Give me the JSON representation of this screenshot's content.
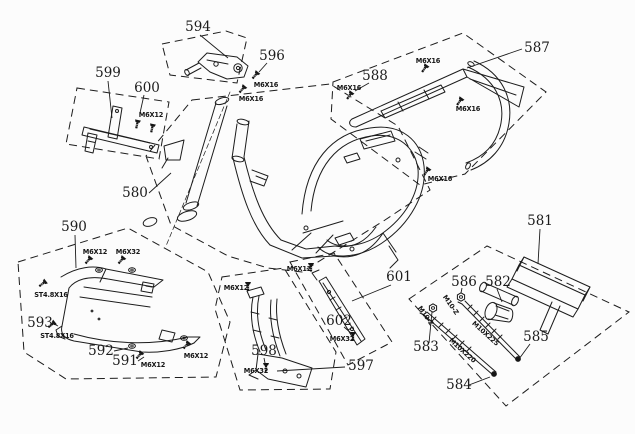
{
  "diagram": {
    "background": "#fcfcfc",
    "line_color": "#1c1c1c",
    "description_labels": {
      "part_numbers": [
        "580",
        "581",
        "582",
        "583",
        "584",
        "585",
        "586",
        "587",
        "588",
        "590",
        "591",
        "592",
        "593",
        "594",
        "596",
        "597",
        "598",
        "599",
        "600",
        "601",
        "602"
      ]
    },
    "callouts": [
      {
        "label": "594",
        "x": 198,
        "y": 31,
        "leader": [
          200,
          35,
          228,
          58
        ]
      },
      {
        "label": "596",
        "x": 272,
        "y": 60,
        "leader": [
          267,
          63,
          259,
          72
        ]
      },
      {
        "label": "599",
        "x": 108,
        "y": 77,
        "leader": [
          108,
          81,
          112,
          118
        ]
      },
      {
        "label": "600",
        "x": 147,
        "y": 92,
        "leader": [
          144,
          95,
          140,
          113
        ]
      },
      {
        "label": "587",
        "x": 537,
        "y": 52,
        "leader": [
          522,
          49,
          467,
          68
        ]
      },
      {
        "label": "588",
        "x": 375,
        "y": 80,
        "leader": [
          369,
          83,
          355,
          91
        ]
      },
      {
        "label": "580",
        "x": 135,
        "y": 197,
        "leader": [
          149,
          193,
          171,
          173
        ]
      },
      {
        "label": "590",
        "x": 74,
        "y": 231,
        "leader": [
          75,
          235,
          76,
          268
        ]
      },
      {
        "label": "593",
        "x": 40,
        "y": 327,
        "leader": [
          52,
          323,
          58,
          326
        ]
      },
      {
        "label": "592",
        "x": 101,
        "y": 355,
        "leader": [
          114,
          351,
          128,
          348
        ]
      },
      {
        "label": "591",
        "x": 125,
        "y": 365,
        "leader": [
          138,
          361,
          144,
          357
        ]
      },
      {
        "label": "598",
        "x": 264,
        "y": 355,
        "leader": [
          264,
          358,
          265,
          363
        ]
      },
      {
        "label": "597",
        "x": 361,
        "y": 370,
        "leader": [
          345,
          367,
          277,
          371
        ]
      },
      {
        "label": "601",
        "x": 399,
        "y": 281,
        "leader": [
          391,
          285,
          352,
          301
        ]
      },
      {
        "label": "602",
        "x": 339,
        "y": 325,
        "leader": [
          344,
          327,
          351,
          333
        ]
      },
      {
        "label": "581",
        "x": 540,
        "y": 225,
        "leader": [
          540,
          229,
          538,
          264
        ]
      },
      {
        "label": "586",
        "x": 464,
        "y": 286,
        "leader": [
          462,
          288,
          461,
          293
        ]
      },
      {
        "label": "582",
        "x": 498,
        "y": 286,
        "leader": [
          497,
          289,
          502,
          302
        ]
      },
      {
        "label": "583",
        "x": 426,
        "y": 351,
        "leader": [
          429,
          343,
          432,
          312
        ]
      },
      {
        "label": "585",
        "x": 536,
        "y": 341,
        "leader": [
          530,
          344,
          519,
          359
        ]
      },
      {
        "label": "584",
        "x": 459,
        "y": 389,
        "leader": [
          469,
          385,
          490,
          377
        ]
      }
    ],
    "fasteners": [
      {
        "label": "M6X16",
        "x": 266,
        "y": 87,
        "glyphs": [
          {
            "type": "bolt",
            "x": 258,
            "y": 72,
            "rot": 40
          }
        ]
      },
      {
        "label": "M6X16",
        "x": 251,
        "y": 101,
        "glyphs": [
          {
            "type": "bolt",
            "x": 245,
            "y": 86,
            "rot": 40
          }
        ]
      },
      {
        "label": "M6X16",
        "x": 428,
        "y": 63,
        "glyphs": [
          {
            "type": "bolt",
            "x": 427,
            "y": 65,
            "rot": 35
          }
        ]
      },
      {
        "label": "M6X16",
        "x": 349,
        "y": 90,
        "glyphs": [
          {
            "type": "bolt",
            "x": 352,
            "y": 92,
            "rot": 35
          }
        ]
      },
      {
        "label": "M6X16",
        "x": 468,
        "y": 111,
        "glyphs": [
          {
            "type": "bolt",
            "x": 462,
            "y": 98,
            "rot": 35
          }
        ]
      },
      {
        "label": "M6X16",
        "x": 440,
        "y": 181,
        "glyphs": [
          {
            "type": "bolt",
            "x": 429,
            "y": 168,
            "rot": 35
          }
        ]
      },
      {
        "label": "M6X12",
        "x": 151,
        "y": 117,
        "glyphs": [
          {
            "type": "bolt",
            "x": 138,
            "y": 120,
            "rot": 12
          },
          {
            "type": "bolt",
            "x": 153,
            "y": 124,
            "rot": 12
          }
        ]
      },
      {
        "label": "M6X12",
        "x": 95,
        "y": 254,
        "glyphs": [
          {
            "type": "bolt",
            "x": 91,
            "y": 257,
            "rot": 40
          },
          {
            "type": "washer",
            "x": 99,
            "y": 270,
            "rot": 0
          }
        ]
      },
      {
        "label": "M6X32",
        "x": 128,
        "y": 254,
        "glyphs": [
          {
            "type": "bolt",
            "x": 124,
            "y": 257,
            "rot": 40
          },
          {
            "type": "washer",
            "x": 132,
            "y": 270,
            "rot": 0
          }
        ]
      },
      {
        "label": "ST4.8X16",
        "x": 51,
        "y": 297,
        "glyphs": [
          {
            "type": "bolt",
            "x": 46,
            "y": 281,
            "rot": 52
          }
        ]
      },
      {
        "label": "ST4.8X16",
        "x": 57,
        "y": 338,
        "glyphs": [
          {
            "type": "bolt",
            "x": 55,
            "y": 322,
            "rot": 52
          }
        ]
      },
      {
        "label": "M6X12",
        "x": 153,
        "y": 367,
        "glyphs": [
          {
            "type": "bolt",
            "x": 142,
            "y": 352,
            "rot": 40
          },
          {
            "type": "washer",
            "x": 132,
            "y": 346,
            "rot": 0
          }
        ]
      },
      {
        "label": "M6X12",
        "x": 196,
        "y": 358,
        "glyphs": [
          {
            "type": "bolt",
            "x": 189,
            "y": 342,
            "rot": 40
          },
          {
            "type": "washer",
            "x": 184,
            "y": 338,
            "rot": 0
          }
        ]
      },
      {
        "label": "M6X12",
        "x": 236,
        "y": 290,
        "glyphs": [
          {
            "type": "bolt",
            "x": 248,
            "y": 282,
            "rot": 0
          }
        ]
      },
      {
        "label": "M6X12",
        "x": 299,
        "y": 271,
        "glyphs": [
          {
            "type": "bolt",
            "x": 311,
            "y": 263,
            "rot": 0
          }
        ]
      },
      {
        "label": "M6X32",
        "x": 342,
        "y": 341,
        "glyphs": [
          {
            "type": "bolt",
            "x": 353,
            "y": 332,
            "rot": 0
          }
        ]
      },
      {
        "label": "M6X32",
        "x": 256,
        "y": 373,
        "glyphs": [
          {
            "type": "bolt",
            "x": 266,
            "y": 363,
            "rot": 0
          }
        ]
      },
      {
        "label": "M10-Z",
        "x": 449,
        "y": 306,
        "rot": 55,
        "glyphs": [
          {
            "type": "nut",
            "x": 461,
            "y": 297,
            "rot": 0
          }
        ]
      },
      {
        "label": "M10-Z",
        "x": 424,
        "y": 317,
        "rot": 55,
        "glyphs": [
          {
            "type": "nut",
            "x": 433,
            "y": 308,
            "rot": 0
          }
        ]
      },
      {
        "label": "M10X225",
        "x": 484,
        "y": 335,
        "rot": 42,
        "glyphs": []
      },
      {
        "label": "M10X220",
        "x": 461,
        "y": 352,
        "rot": 42,
        "glyphs": []
      }
    ]
  }
}
